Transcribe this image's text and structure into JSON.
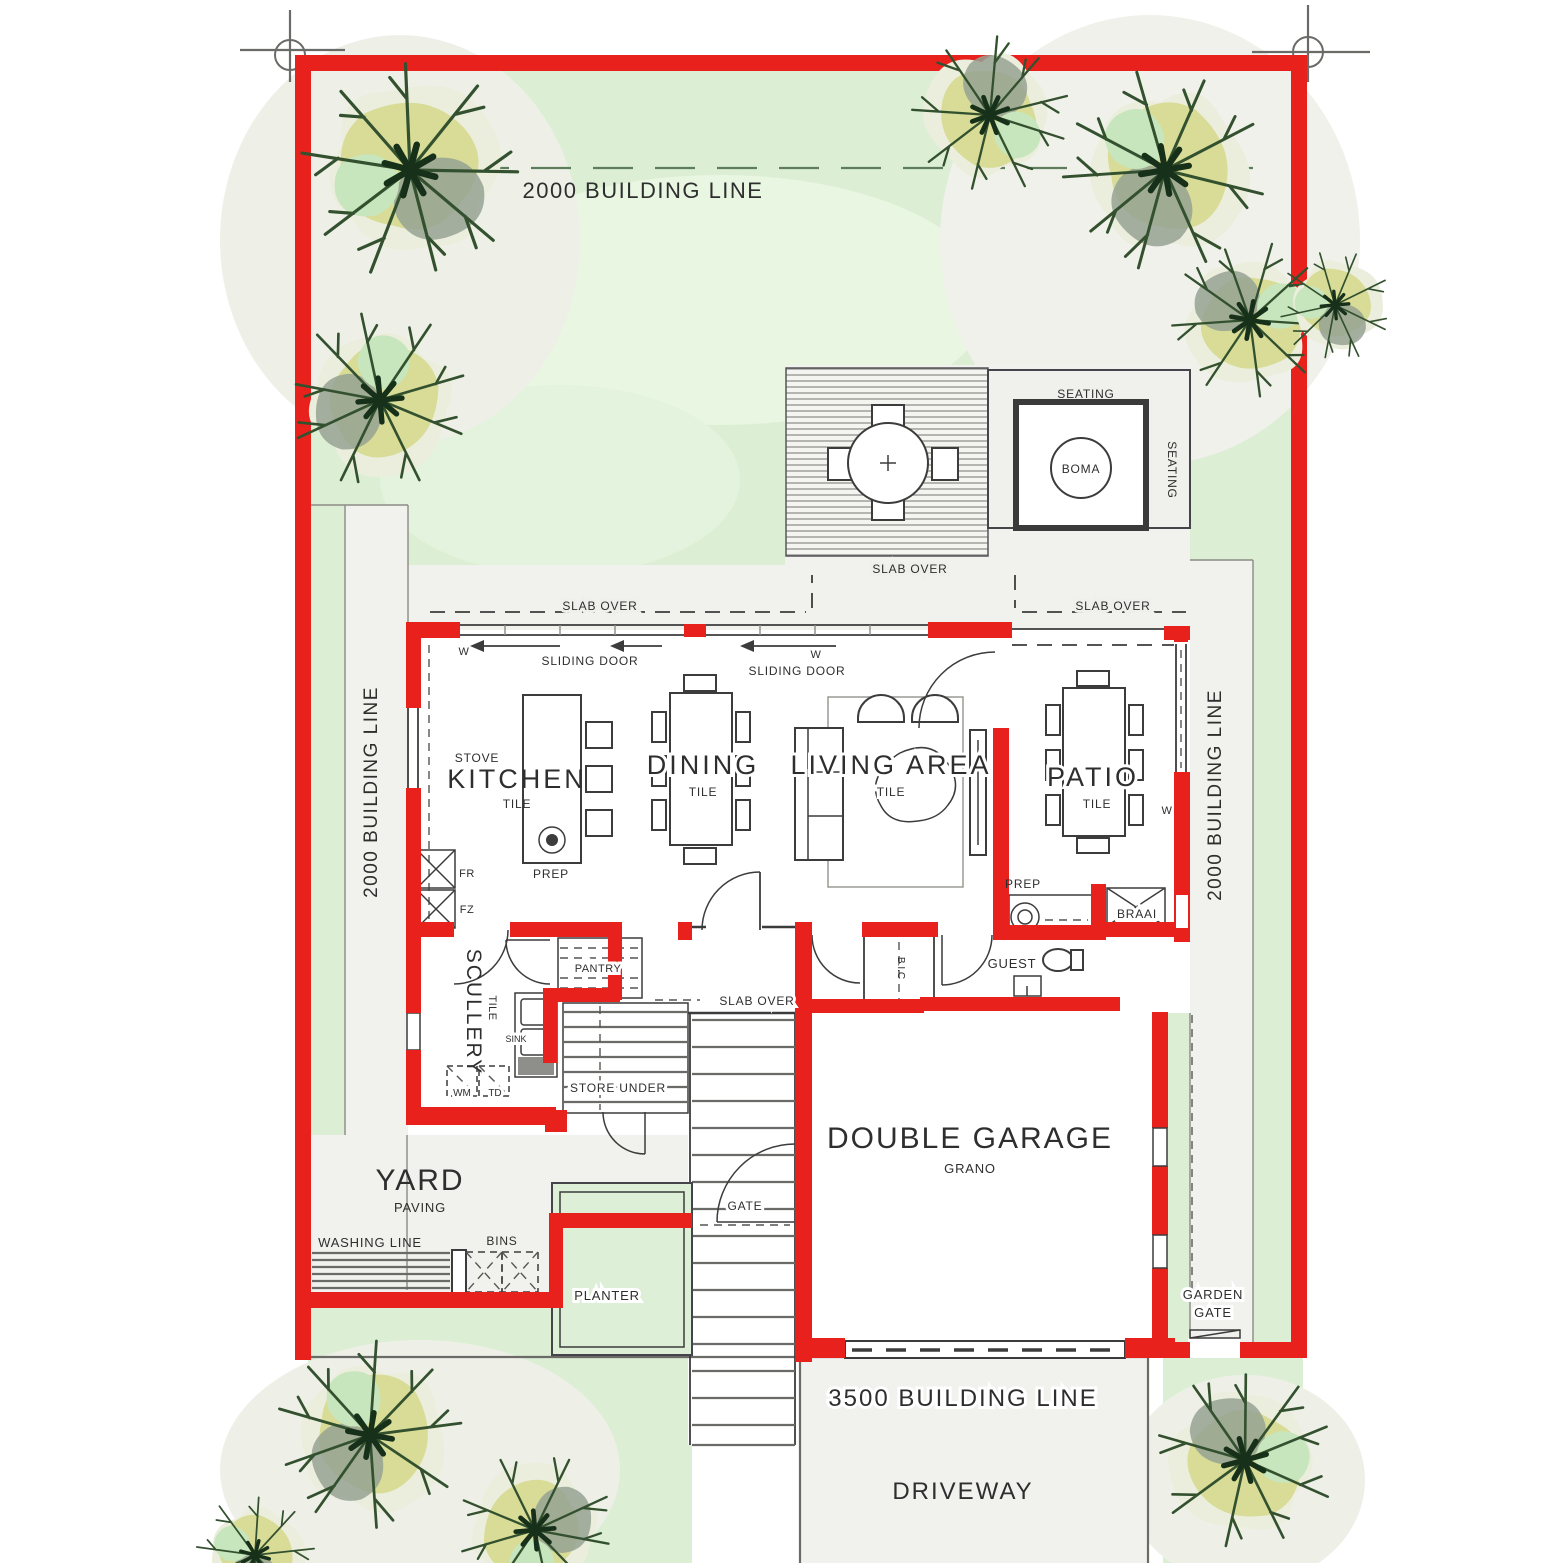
{
  "site": {
    "building_line_top": "2000 BUILDING LINE",
    "building_line_left": "2000 BUILDING LINE",
    "building_line_right": "2000 BUILDING LINE",
    "building_line_front": "3500 BUILDING LINE",
    "driveway": "DRIVEWAY",
    "yard": "YARD",
    "yard_finish": "PAVING"
  },
  "outdoor": {
    "seating_top": "SEATING",
    "seating_side": "SEATING",
    "boma": "BOMA",
    "slab_over_deck": "SLAB OVER",
    "slab_over_west": "SLAB OVER",
    "slab_over_east": "SLAB OVER",
    "slab_over_entry": "SLAB OVER",
    "washing_line": "WASHING LINE",
    "bins": "BINS",
    "planter": "PLANTER"
  },
  "rooms": {
    "kitchen": {
      "name": "KITCHEN",
      "finish": "TILE"
    },
    "dining": {
      "name": "DINING",
      "finish": "TILE"
    },
    "living": {
      "name": "LIVING AREA",
      "finish": "TILE"
    },
    "patio": {
      "name": "PATIO",
      "finish": "TILE"
    },
    "scullery": {
      "name": "SCULLERY",
      "finish": "TILE"
    },
    "pantry": {
      "name": "PANTRY"
    },
    "guest_wc": {
      "name": "GUEST"
    },
    "bic": {
      "name": "B.I.C"
    },
    "store_under_stairs": {
      "name": "STORE UNDER"
    },
    "garage": {
      "name": "DOUBLE GARAGE",
      "finish": "GRANO"
    }
  },
  "fixtures": {
    "stove": "STOVE",
    "kitchen_prep": "PREP",
    "patio_prep": "PREP",
    "fridge": "FR",
    "freezer": "FZ",
    "sink": "SINK",
    "washing_machine": "WM",
    "tumble_dryer": "TD",
    "braai": "BRAAI"
  },
  "doors": {
    "sliding_door_kitchen": "SLIDING DOOR",
    "sliding_door_living": "SLIDING DOOR",
    "yard_gate": "GATE",
    "garden_gate_l1": "GARDEN",
    "garden_gate_l2": "GATE",
    "window_marker": "W"
  },
  "colors": {
    "wall_red": "#e8211d",
    "garden_green": "#dcefd5",
    "paving_grey": "#f1f1ee",
    "tree_olive": "#d6d98e",
    "tree_grey": "#97a294",
    "line_dark": "#3c3c3c"
  }
}
